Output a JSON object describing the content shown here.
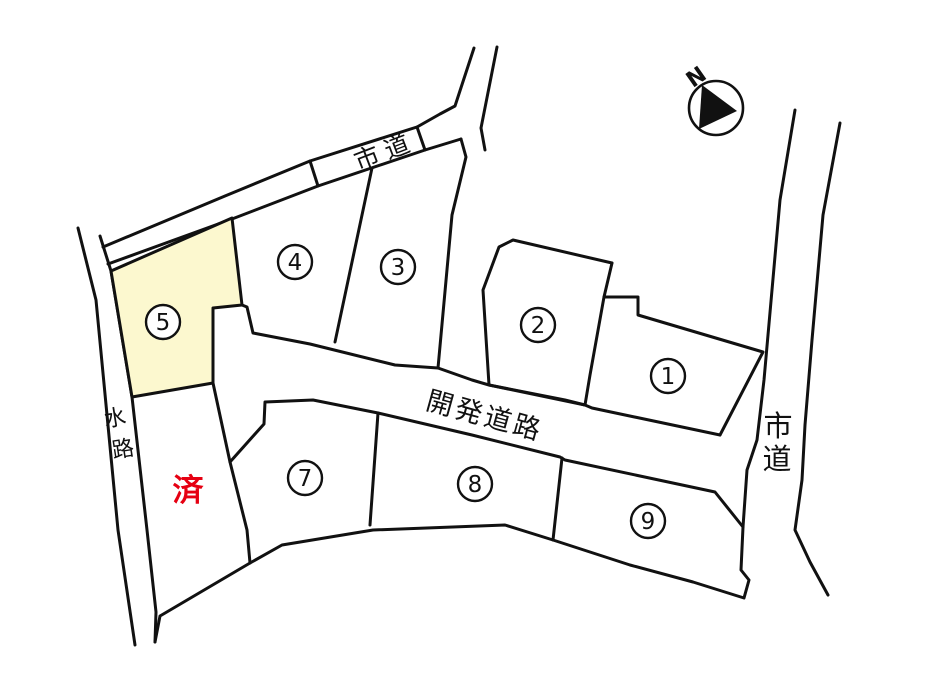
{
  "map": {
    "background": "#ffffff",
    "line_color": "#111111",
    "highlight_fill": "#fcf8cf",
    "sold_color": "#e60012"
  },
  "compass": {
    "label": "N"
  },
  "roads": {
    "city_road_top": {
      "label": "市道"
    },
    "city_road_right": {
      "label": "市道",
      "char1": "市",
      "char2": "道"
    },
    "development_road": {
      "label": "開発道路"
    },
    "waterway": {
      "label": "水路",
      "char1": "水",
      "char2": "路"
    }
  },
  "sold_label": "済",
  "highlighted_lot": "5",
  "lots": [
    {
      "id": "lot-1",
      "number": "1"
    },
    {
      "id": "lot-2",
      "number": "2"
    },
    {
      "id": "lot-3",
      "number": "3"
    },
    {
      "id": "lot-4",
      "number": "4"
    },
    {
      "id": "lot-5",
      "number": "5"
    },
    {
      "id": "lot-7",
      "number": "7"
    },
    {
      "id": "lot-8",
      "number": "8"
    },
    {
      "id": "lot-9",
      "number": "9"
    }
  ]
}
